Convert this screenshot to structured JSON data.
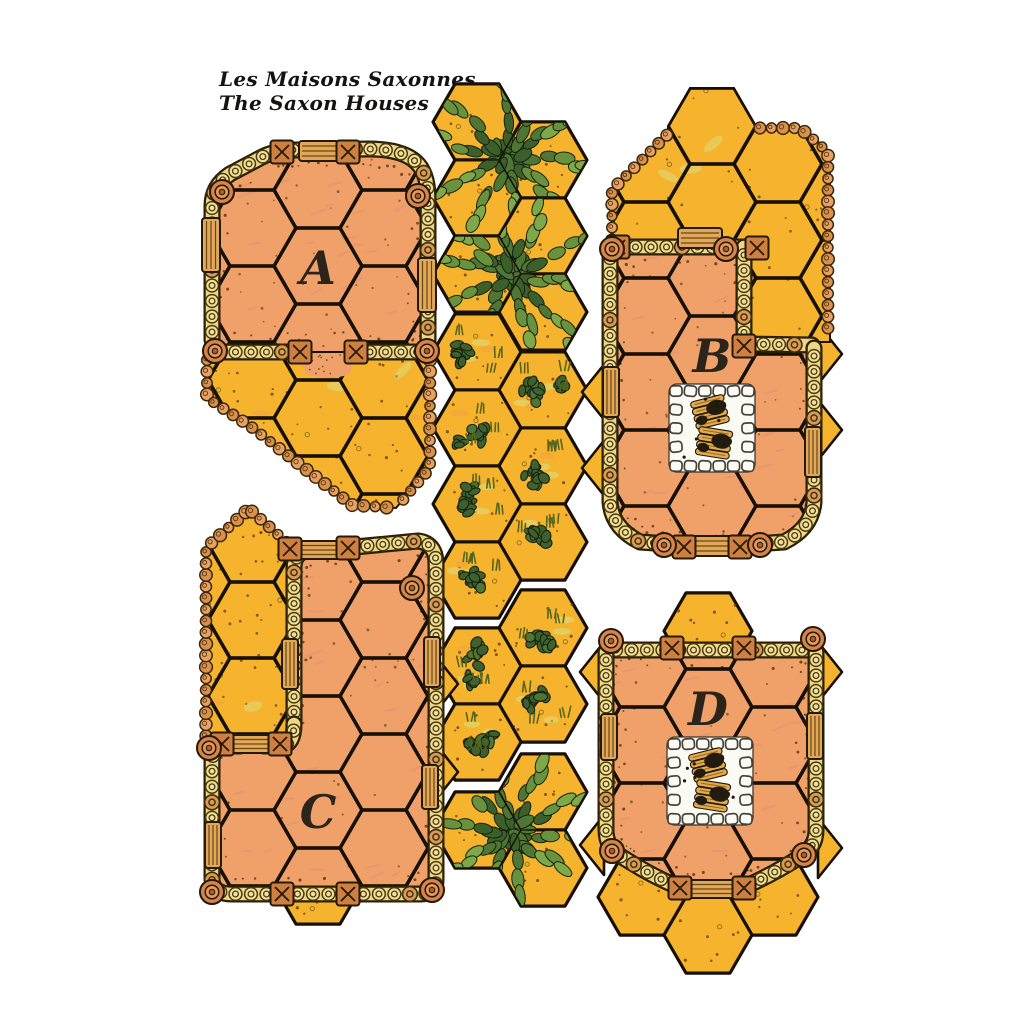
{
  "title": {
    "line1": "Les Maisons Saxonnes",
    "line2": "The Saxon Houses"
  },
  "colors": {
    "paper": "#ffffff",
    "hex_yellow": "#f6b42e",
    "floor": "#f0a169",
    "floor_hatch": "#e28d7b",
    "outline": "#1b1206",
    "grid_line": "#171007",
    "wall_band": "#eed684",
    "wall_band_dark": "#2a2008",
    "wall_link": "#f2e098",
    "wall_knot": "#d89a55",
    "pebble_a": "#e7a263",
    "pebble_b": "#d8924c",
    "wood": "#e2a85a",
    "post": "#cf7f40",
    "roundel": "#d7834a",
    "stone_white": "#fcfbf3",
    "log": "#e3a94e",
    "char": "#221c10",
    "tree_greens": [
      "#3d5f2c",
      "#4f7634",
      "#69923f",
      "#7fa84a"
    ],
    "bush_green": "#3f6130",
    "grass": "#55651c",
    "smudge_green": "#d4e48c",
    "smudge_orange": "#f59b40",
    "speckle": "#6b4413",
    "letter": "#2b241b",
    "title": "#151311"
  },
  "board": {
    "hex_radius": 44,
    "pieces": [
      {
        "id": "a",
        "label": "A",
        "label_pos": [
          318,
          268
        ],
        "grid_origin": [
          318,
          266
        ],
        "regions": [
          {
            "name": "courtyard",
            "fill": "yellow",
            "texture": "court",
            "path": "M 208,352 L 430,352 L 430,468 L 396,508 L 352,506 L 250,426 L 207,398 Z",
            "bbox": [
              200,
              344,
              436,
              514
            ]
          },
          {
            "name": "floor",
            "fill": "floor",
            "texture": "floor",
            "path": "M 212,352 L 212,206 Q 212,186 230,174 L 262,157 Q 276,150 296,150 L 368,149 Q 402,149 416,162 Q 428,173 428,198 L 428,352 Z",
            "bbox": [
              200,
              140,
              436,
              362
            ]
          }
        ],
        "exit_hexes": [],
        "door_spill": "M 298,353 L 356,353 L 350,374 Q 328,382 306,374 Z",
        "walls": [
          "M 212,340 L 212,206 Q 212,186 230,174 L 262,157 Q 276,150 296,150 L 368,149 Q 402,149 416,162 Q 428,173 428,198 L 428,340",
          "M 212,352 L 292,352",
          "M 362,352 L 428,352"
        ],
        "pebbles": [
          "M 207,356 L 207,398 L 250,426 L 352,505 L 394,508",
          "M 430,356 L 430,468 L 398,506"
        ],
        "planks": [
          [
            319,
            151,
            40,
            20
          ],
          [
            211,
            245,
            18,
            54
          ],
          [
            427,
            285,
            18,
            54
          ]
        ],
        "xposts": [
          [
            282,
            152
          ],
          [
            348,
            152
          ],
          [
            300,
            352
          ],
          [
            356,
            352
          ]
        ],
        "roundels": [
          [
            222,
            192
          ],
          [
            418,
            196
          ],
          [
            215,
            351
          ],
          [
            427,
            351
          ]
        ],
        "firepit": null,
        "wedges": []
      },
      {
        "id": "b",
        "label": "B",
        "label_pos": [
          712,
          356
        ],
        "grid_origin": [
          712,
          354
        ],
        "regions": [
          {
            "name": "courtyard",
            "fill": "yellow",
            "texture": "court",
            "path": "M 612,246 L 612,190 L 668,134 L 668,126 L 690,88 L 734,88 L 756,126 L 756,128 L 802,128 L 830,152 L 830,342 L 748,342 L 748,246 Z",
            "bbox": [
              600,
              84,
              834,
              346
            ]
          },
          {
            "name": "floor",
            "fill": "floor",
            "texture": "floor",
            "path": "M 610,250 Q 610,247 614,247 L 744,247 L 744,344 L 812,344 Q 816,344 816,348 L 816,502 Q 816,530 782,544 L 642,544 Q 610,530 610,502 Z",
            "bbox": [
              598,
              240,
              826,
              556
            ]
          }
        ],
        "exit_hexes": [],
        "door_spill": null,
        "walls": [
          "M 612,247 L 744,247",
          "M 744,247 L 744,344 L 812,345",
          "M 610,250 L 610,502 Q 612,528 640,542 L 698,546",
          "M 814,348 L 814,502 Q 812,528 784,542 L 726,546"
        ],
        "pebbles": [
          "M 612,243 L 612,190 L 668,134 L 668,128",
          "M 756,128 L 800,128 L 828,152 L 828,338"
        ],
        "planks": [
          [
            700,
            238,
            44,
            20
          ],
          [
            611,
            392,
            16,
            50
          ],
          [
            813,
            452,
            16,
            50
          ],
          [
            712,
            546,
            52,
            20
          ]
        ],
        "xposts": [
          [
            618,
            247
          ],
          [
            757,
            248
          ],
          [
            744,
            346
          ],
          [
            684,
            547
          ],
          [
            740,
            547
          ]
        ],
        "roundels": [
          [
            726,
            249
          ],
          [
            612,
            249
          ],
          [
            664,
            545
          ],
          [
            760,
            545
          ]
        ],
        "firepit": [
          712,
          428
        ],
        "wedges": [
          [
            606,
            392,
            "w"
          ],
          [
            606,
            468,
            "w"
          ],
          [
            818,
            354,
            "e"
          ],
          [
            818,
            430,
            "e"
          ]
        ]
      },
      {
        "id": "c",
        "label": "C",
        "label_pos": [
          318,
          812
        ],
        "grid_origin": [
          318,
          810
        ],
        "regions": [
          {
            "name": "courtyard",
            "fill": "yellow",
            "texture": "court",
            "path": "M 206,742 L 206,547 L 249,508 L 292,546 L 292,742 Z",
            "bbox": [
              198,
              500,
              298,
              748
            ]
          },
          {
            "name": "floor",
            "fill": "floor",
            "texture": "floor",
            "path": "M 294,722 L 294,568 Q 294,552 312,549 L 416,541 Q 436,542 436,564 L 436,878 Q 436,894 418,894 L 232,894 Q 212,894 212,876 L 212,764 Q 212,748 232,746 L 278,746 Q 294,740 294,722 Z",
            "bbox": [
              204,
              534,
              446,
              904
            ]
          }
        ],
        "exit_hexes": [
          [
            318,
            886
          ]
        ],
        "door_spill": null,
        "walls": [
          "M 294,720 L 294,568 Q 294,552 310,550 L 344,548",
          "M 344,548 L 418,541 Q 436,543 436,564 L 436,880 Q 436,894 420,894 L 352,894",
          "M 352,894 L 232,894 Q 212,894 212,878 L 212,762 Q 212,746 230,746 L 240,746",
          "M 264,746 L 284,746 Q 294,742 294,724"
        ],
        "pebbles": [
          "M 206,740 L 206,548 L 249,509",
          "M 249,509 L 291,546"
        ],
        "planks": [
          [
            318,
            550,
            52,
            18
          ],
          [
            252,
            744,
            44,
            18
          ],
          [
            290,
            664,
            16,
            50
          ],
          [
            213,
            845,
            16,
            46
          ],
          [
            432,
            662,
            16,
            50
          ],
          [
            430,
            787,
            16,
            44
          ]
        ],
        "xposts": [
          [
            290,
            549
          ],
          [
            348,
            548
          ],
          [
            222,
            744
          ],
          [
            280,
            744
          ],
          [
            282,
            894
          ],
          [
            348,
            894
          ]
        ],
        "roundels": [
          [
            412,
            588
          ],
          [
            212,
            892
          ],
          [
            432,
            890
          ],
          [
            209,
            748
          ]
        ],
        "firepit": null,
        "wedges": [
          [
            434,
            684,
            "e"
          ],
          [
            434,
            772,
            "e"
          ]
        ]
      },
      {
        "id": "d",
        "label": "D",
        "label_pos": [
          708,
          709
        ],
        "grid_origin": [
          708,
          707
        ],
        "regions": [
          {
            "name": "floor",
            "fill": "floor",
            "texture": "floor",
            "path": "M 606,652 Q 606,648 612,648 L 810,648 Q 816,648 816,652 L 816,830 Q 816,850 798,860 Q 760,884 744,888 L 678,888 Q 662,884 624,860 Q 606,850 606,830 Z",
            "bbox": [
              598,
              590,
              824,
              900
            ]
          }
        ],
        "exit_hexes": [
          [
            708,
            631
          ],
          [
            642,
            897
          ],
          [
            774,
            897
          ],
          [
            708,
            935
          ]
        ],
        "door_spill": null,
        "walls": [
          "M 608,650 L 814,650",
          "M 606,652 L 606,830 Q 606,848 622,857 Q 652,876 676,886",
          "M 816,652 L 816,830 Q 816,848 800,857 Q 770,876 746,886"
        ],
        "pebbles": [],
        "planks": [
          [
            609,
            737,
            16,
            46
          ],
          [
            815,
            736,
            16,
            46
          ],
          [
            712,
            889,
            50,
            18
          ]
        ],
        "xposts": [
          [
            672,
            648
          ],
          [
            744,
            648
          ],
          [
            680,
            888
          ],
          [
            744,
            888
          ]
        ],
        "roundels": [
          [
            611,
            641
          ],
          [
            813,
            639
          ],
          [
            612,
            851
          ],
          [
            804,
            855
          ]
        ],
        "firepit": [
          710,
          781
        ],
        "wedges": [
          [
            604,
            672,
            "w"
          ],
          [
            604,
            845,
            "w"
          ],
          [
            818,
            672,
            "e"
          ],
          [
            818,
            848,
            "e"
          ]
        ]
      }
    ],
    "terrain_groups": [
      {
        "type": "tree",
        "seed": 11,
        "hexes": [
          [
            477,
            122
          ],
          [
            543,
            160
          ],
          [
            477,
            198
          ]
        ],
        "canopy": [
          508,
          158,
          95
        ]
      },
      {
        "type": "tree",
        "seed": 23,
        "hexes": [
          [
            543,
            236
          ],
          [
            477,
            274
          ],
          [
            543,
            312
          ]
        ],
        "canopy": [
          512,
          274,
          95
        ]
      },
      {
        "type": "brush",
        "seed": 37,
        "hexes": [
          [
            477,
            352
          ],
          [
            543,
            390
          ],
          [
            477,
            428
          ],
          [
            543,
            466
          ],
          [
            477,
            504
          ],
          [
            543,
            542
          ],
          [
            477,
            580
          ]
        ]
      },
      {
        "type": "brush",
        "seed": 53,
        "hexes": [
          [
            543,
            628
          ],
          [
            477,
            666
          ],
          [
            543,
            704
          ],
          [
            477,
            742
          ]
        ]
      },
      {
        "type": "tree",
        "seed": 71,
        "hexes": [
          [
            543,
            792
          ],
          [
            477,
            830
          ],
          [
            543,
            868
          ]
        ],
        "canopy": [
          510,
          832,
          98
        ]
      }
    ]
  }
}
